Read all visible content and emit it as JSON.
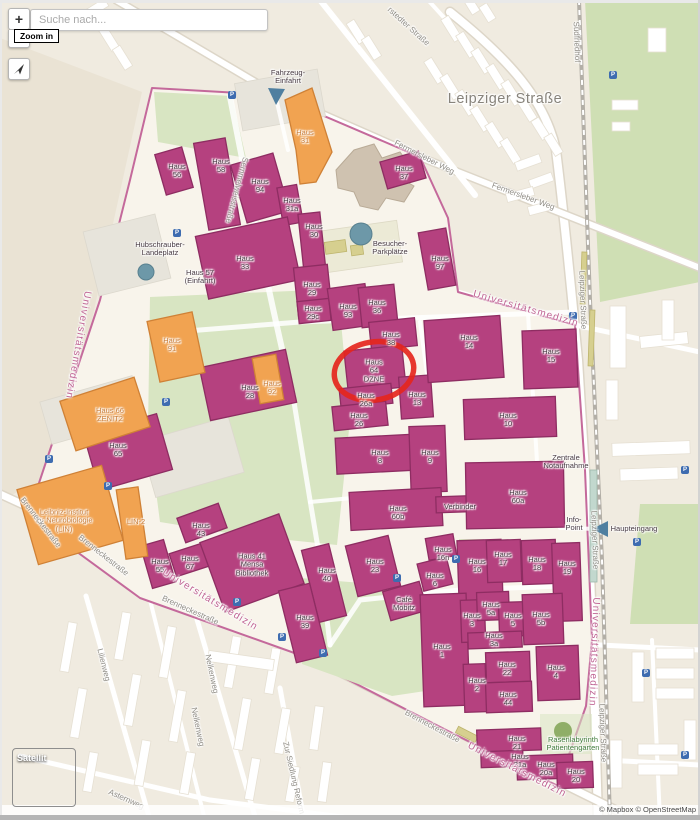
{
  "controls": {
    "search_placeholder": "Suche nach...",
    "zoom_in_label": "+",
    "zoom_out_label": "−",
    "zoom_tooltip": "Zoom in",
    "satellite_label": "Satellit"
  },
  "attribution": {
    "text": "© Mapbox © OpenStreetMap"
  },
  "colors": {
    "map_bg": "#f0ebe0",
    "outside_shade": "#eae3d4",
    "campus_fill": "#f8f4eb",
    "campus_stroke": "#c4699b",
    "building_fill": "#b5417f",
    "building_stroke": "#8e2d62",
    "orange_fill": "#f1a351",
    "orange_stroke": "#cf8136",
    "tan_fill": "#cfc2b0",
    "tan_stroke": "#b9ab97",
    "green_fill": "#d8e5c2",
    "cemetery_fill": "#cfdfb4",
    "khaki_fill": "#d6cf8f",
    "khaki_stroke": "#bdb46c",
    "teal": "#6d98a8",
    "road_casing": "#ddd6c8",
    "rail": "#b3afa7",
    "grey_patch": "#e7e4db",
    "dark_text": "#473a43",
    "street_text": "#8f8c85",
    "pink_text": "#c06594",
    "orange_text": "#c97d38",
    "green_text": "#417c3c",
    "red_highlight": "#e5261d",
    "p_icon": "#3e6cb0",
    "tree_green": "#8fae67"
  },
  "parking": [
    [
      232,
      95
    ],
    [
      613,
      75
    ],
    [
      177,
      233
    ],
    [
      573,
      316
    ],
    [
      166,
      402
    ],
    [
      49,
      459
    ],
    [
      108,
      486
    ],
    [
      397,
      578
    ],
    [
      456,
      559
    ],
    [
      637,
      542
    ],
    [
      685,
      470
    ],
    [
      237,
      602
    ],
    [
      282,
      637
    ],
    [
      323,
      653
    ],
    [
      646,
      673
    ],
    [
      685,
      755
    ]
  ],
  "map_labels": [
    {
      "n": "haus-56-label",
      "t": "Haus\n56",
      "x": 177,
      "y": 171,
      "c": ""
    },
    {
      "n": "haus-58-label",
      "t": "Haus\n58",
      "x": 221,
      "y": 166,
      "c": ""
    },
    {
      "n": "haus-94-label",
      "t": "Haus\n94",
      "x": 260,
      "y": 186,
      "c": ""
    },
    {
      "n": "haus-31-label",
      "t": "Haus\n31",
      "x": 305,
      "y": 137,
      "c": "o"
    },
    {
      "n": "haus-31a-label",
      "t": "Haus\n31a",
      "x": 292,
      "y": 205,
      "c": ""
    },
    {
      "n": "haus-30-label",
      "t": "Haus\n30",
      "x": 314,
      "y": 231,
      "c": ""
    },
    {
      "n": "haus-37-label",
      "t": "Haus\n37",
      "x": 404,
      "y": 173,
      "c": ""
    },
    {
      "n": "haus-33-label",
      "t": "Haus\n33",
      "x": 245,
      "y": 263,
      "c": ""
    },
    {
      "n": "haus-57-label",
      "t": "Haus 57\n(Einfahrt)",
      "x": 200,
      "y": 277,
      "c": ""
    },
    {
      "n": "haus-29-label",
      "t": "Haus\n29",
      "x": 312,
      "y": 289,
      "c": ""
    },
    {
      "n": "haus-29c-label",
      "t": "Haus\n29c",
      "x": 313,
      "y": 313,
      "c": ""
    },
    {
      "n": "haus-93-label",
      "t": "Haus\n93",
      "x": 348,
      "y": 311,
      "c": ""
    },
    {
      "n": "haus-36-label",
      "t": "Haus\n36",
      "x": 377,
      "y": 307,
      "c": ""
    },
    {
      "n": "haus-38-label",
      "t": "Haus\n38",
      "x": 391,
      "y": 339,
      "c": ""
    },
    {
      "n": "haus-64-dzne-label",
      "t": "Haus\n64\nDZNE",
      "x": 374,
      "y": 371,
      "c": ""
    },
    {
      "n": "haus-26a-label",
      "t": "Haus\n26a",
      "x": 366,
      "y": 400,
      "c": ""
    },
    {
      "n": "haus-26-label",
      "t": "Haus\n26",
      "x": 359,
      "y": 420,
      "c": ""
    },
    {
      "n": "haus-13-label",
      "t": "Haus\n13",
      "x": 417,
      "y": 399,
      "c": ""
    },
    {
      "n": "haus-14-label",
      "t": "Haus\n14",
      "x": 469,
      "y": 342,
      "c": ""
    },
    {
      "n": "haus-15-label",
      "t": "Haus\n15",
      "x": 551,
      "y": 356,
      "c": ""
    },
    {
      "n": "haus-97-label",
      "t": "Haus\n97",
      "x": 440,
      "y": 263,
      "c": ""
    },
    {
      "n": "haus-10-label",
      "t": "Haus\n10",
      "x": 508,
      "y": 420,
      "c": ""
    },
    {
      "n": "haus-8-label",
      "t": "Haus\n8",
      "x": 380,
      "y": 457,
      "c": ""
    },
    {
      "n": "haus-9-label",
      "t": "Haus\n9",
      "x": 430,
      "y": 457,
      "c": ""
    },
    {
      "n": "haus-28-label",
      "t": "Haus\n28",
      "x": 250,
      "y": 392,
      "c": ""
    },
    {
      "n": "haus-91-label",
      "t": "Haus\n91",
      "x": 172,
      "y": 345,
      "c": "o"
    },
    {
      "n": "haus-92-label",
      "t": "Haus\n92",
      "x": 272,
      "y": 388,
      "c": "o"
    },
    {
      "n": "haus-66-zenit2-label",
      "t": "Haus 66\nZENIT2",
      "x": 110,
      "y": 415,
      "c": "o"
    },
    {
      "n": "haus-65-label",
      "t": "Haus\n65",
      "x": 118,
      "y": 450,
      "c": ""
    },
    {
      "n": "lin-2-label",
      "t": "LIN-2",
      "x": 136,
      "y": 522,
      "c": "o"
    },
    {
      "n": "leibniz-institut-label",
      "t": "Leibniz-Institut\nfür Neurobiologie\n(LIN)",
      "x": 64,
      "y": 521,
      "c": "o"
    },
    {
      "n": "haus-43-label",
      "t": "Haus\n43",
      "x": 201,
      "y": 530,
      "c": ""
    },
    {
      "n": "haus-67-label",
      "t": "Haus\n67",
      "x": 190,
      "y": 563,
      "c": ""
    },
    {
      "n": "haus-55-label",
      "t": "Haus\n55",
      "x": 160,
      "y": 566,
      "c": ""
    },
    {
      "n": "haus-41-mensa-label",
      "t": "Haus 41\nMensa\nBibliothek",
      "x": 252,
      "y": 565,
      "c": ""
    },
    {
      "n": "haus-60b-label",
      "t": "Haus\n60b",
      "x": 398,
      "y": 513,
      "c": ""
    },
    {
      "n": "verbinder-label",
      "t": "Verbinder",
      "x": 460,
      "y": 507,
      "c": ""
    },
    {
      "n": "haus-60a-label",
      "t": "Haus\n60a",
      "x": 518,
      "y": 497,
      "c": ""
    },
    {
      "n": "zentrale-notaufnahme-label",
      "t": "Zentrale\nNotaufnahme",
      "x": 566,
      "y": 462,
      "c": ""
    },
    {
      "n": "info-point-label",
      "t": "Info-\nPoint",
      "x": 574,
      "y": 524,
      "c": ""
    },
    {
      "n": "haupteingang-label",
      "t": "Haupteingang",
      "x": 634,
      "y": 529,
      "c": ""
    },
    {
      "n": "haus-40-label",
      "t": "Haus\n40",
      "x": 327,
      "y": 575,
      "c": ""
    },
    {
      "n": "haus-23-label",
      "t": "Haus\n23",
      "x": 375,
      "y": 566,
      "c": ""
    },
    {
      "n": "haus-16n-label",
      "t": "Haus\n16n",
      "x": 443,
      "y": 554,
      "c": ""
    },
    {
      "n": "haus-6-label",
      "t": "Haus\n6",
      "x": 435,
      "y": 580,
      "c": ""
    },
    {
      "n": "haus-16-label",
      "t": "Haus\n16",
      "x": 477,
      "y": 566,
      "c": ""
    },
    {
      "n": "haus-17-label",
      "t": "Haus\n17",
      "x": 503,
      "y": 559,
      "c": ""
    },
    {
      "n": "haus-18-label",
      "t": "Haus\n18",
      "x": 537,
      "y": 564,
      "c": ""
    },
    {
      "n": "haus-19-label",
      "t": "Haus\n19",
      "x": 567,
      "y": 568,
      "c": ""
    },
    {
      "n": "cafe-mobitz-label",
      "t": "Café\nMobitz",
      "x": 404,
      "y": 604,
      "c": ""
    },
    {
      "n": "haus-39-label",
      "t": "Haus\n39",
      "x": 305,
      "y": 622,
      "c": ""
    },
    {
      "n": "haus-1-label",
      "t": "Haus\n1",
      "x": 442,
      "y": 651,
      "c": ""
    },
    {
      "n": "haus-3-label",
      "t": "Haus\n3",
      "x": 472,
      "y": 620,
      "c": ""
    },
    {
      "n": "haus-5a-label",
      "t": "Haus\n5a",
      "x": 491,
      "y": 609,
      "c": ""
    },
    {
      "n": "haus-5-label",
      "t": "Haus\n5",
      "x": 513,
      "y": 620,
      "c": ""
    },
    {
      "n": "haus-5b-label",
      "t": "Haus\n5b",
      "x": 541,
      "y": 619,
      "c": ""
    },
    {
      "n": "haus-3a-label",
      "t": "Haus\n3a",
      "x": 494,
      "y": 640,
      "c": ""
    },
    {
      "n": "haus-22-label",
      "t": "Haus\n22",
      "x": 507,
      "y": 669,
      "c": ""
    },
    {
      "n": "haus-2-label",
      "t": "Haus\n2",
      "x": 477,
      "y": 685,
      "c": ""
    },
    {
      "n": "haus-4-label",
      "t": "Haus\n4",
      "x": 556,
      "y": 672,
      "c": ""
    },
    {
      "n": "haus-44-label",
      "t": "Haus\n44",
      "x": 508,
      "y": 699,
      "c": ""
    },
    {
      "n": "haus-21-label",
      "t": "Haus\n21",
      "x": 517,
      "y": 743,
      "c": ""
    },
    {
      "n": "haus-21a-label",
      "t": "Haus\n21a",
      "x": 520,
      "y": 761,
      "c": ""
    },
    {
      "n": "haus-20a-label",
      "t": "Haus\n20a",
      "x": 546,
      "y": 769,
      "c": ""
    },
    {
      "n": "haus-20-label",
      "t": "Haus\n20",
      "x": 576,
      "y": 776,
      "c": ""
    },
    {
      "n": "rasenlabyrinth-label",
      "t": "Rasenlabyrinth\nPatientengarten",
      "x": 573,
      "y": 744,
      "c": "g"
    },
    {
      "n": "hubschrauber-landeplatz-label",
      "t": "Hubschrauber-\nLandeplatz",
      "x": 160,
      "y": 249,
      "c": ""
    },
    {
      "n": "besucher-parkplaetze-label",
      "t": "Besucher-\nParkplätze",
      "x": 390,
      "y": 248,
      "c": ""
    },
    {
      "n": "fahrzeug-einfahrt-label",
      "t": "Fahrzeug-\nEinfahrt",
      "x": 288,
      "y": 77,
      "c": ""
    },
    {
      "n": "street-leipziger-strasse-big",
      "t": "Leipziger Straße",
      "x": 505,
      "y": 100,
      "c": "big"
    },
    {
      "n": "street-suedfriedhof",
      "t": "Südfriedhof",
      "x": 576,
      "y": 42,
      "r": 88,
      "c": "s"
    },
    {
      "n": "street-stedter-strasse",
      "t": "rstedter Straße",
      "x": 408,
      "y": 27,
      "r": 42,
      "c": "s"
    },
    {
      "n": "street-fermersleber-weg-1",
      "t": "Fermersleber Weg",
      "x": 424,
      "y": 158,
      "r": 27,
      "c": "s"
    },
    {
      "n": "street-fermersleber-weg-2",
      "t": "Fermersleber Weg",
      "x": 523,
      "y": 197,
      "r": 20,
      "c": "s"
    },
    {
      "n": "street-semmelweisstrasse",
      "t": "Semmelweisstraße",
      "x": 236,
      "y": 190,
      "r": 105,
      "c": "s"
    },
    {
      "n": "boundary-universitaetsmedizin-ne",
      "t": "Universitätsmedizin",
      "x": 526,
      "y": 309,
      "r": 16,
      "c": "p"
    },
    {
      "n": "boundary-universitaetsmedizin-e",
      "t": "Universitätsmedizin",
      "x": 594,
      "y": 652,
      "r": 92,
      "c": "p"
    },
    {
      "n": "boundary-universitaetsmedizin-sw",
      "t": "Universitätsmedizin",
      "x": 210,
      "y": 600,
      "r": 31,
      "c": "p"
    },
    {
      "n": "boundary-universitaetsmedizin-s",
      "t": "Universitätsmedizin",
      "x": 517,
      "y": 770,
      "r": 27,
      "c": "p"
    },
    {
      "n": "boundary-universitaetsmedizin-w",
      "t": "Universitätsmedizin",
      "x": 78,
      "y": 345,
      "r": 100,
      "c": "p"
    },
    {
      "n": "street-brenneckestrasse-1",
      "t": "Brenneckestraße",
      "x": 40,
      "y": 523,
      "r": 52,
      "c": "s"
    },
    {
      "n": "street-brenneckestrasse-2",
      "t": "Brenneckestraße",
      "x": 103,
      "y": 556,
      "r": 38,
      "c": "s"
    },
    {
      "n": "street-brenneckestrasse-3",
      "t": "Brenneckestraße",
      "x": 190,
      "y": 611,
      "r": 24,
      "c": "s"
    },
    {
      "n": "street-brenneckestrasse-4",
      "t": "Brenneckestraße",
      "x": 432,
      "y": 727,
      "r": 28,
      "c": "s"
    },
    {
      "n": "street-nelkenweg-1",
      "t": "Nelkenweg",
      "x": 211,
      "y": 674,
      "r": 78,
      "c": "s"
    },
    {
      "n": "street-nelkenweg-2",
      "t": "Nelkenweg",
      "x": 197,
      "y": 727,
      "r": 78,
      "c": "s"
    },
    {
      "n": "street-lilienweg",
      "t": "Lilienweg",
      "x": 103,
      "y": 665,
      "r": 76,
      "c": "s"
    },
    {
      "n": "street-asternweg",
      "t": "Asternweg",
      "x": 126,
      "y": 800,
      "r": 24,
      "c": "s"
    },
    {
      "n": "street-zur-siedlung-reform",
      "t": "Zur Siedlung Reform",
      "x": 293,
      "y": 778,
      "r": 77,
      "c": "s"
    },
    {
      "n": "street-leipziger-strasse-v1",
      "t": "Leipziger Straße",
      "x": 582,
      "y": 300,
      "r": 88,
      "c": "s"
    },
    {
      "n": "street-leipziger-strasse-v2",
      "t": "Leipziger Straße",
      "x": 594,
      "y": 540,
      "r": 88,
      "c": "s"
    },
    {
      "n": "street-leipziger-strasse-v3",
      "t": "Leipziger Straße",
      "x": 602,
      "y": 733,
      "r": 88,
      "c": "s"
    }
  ]
}
